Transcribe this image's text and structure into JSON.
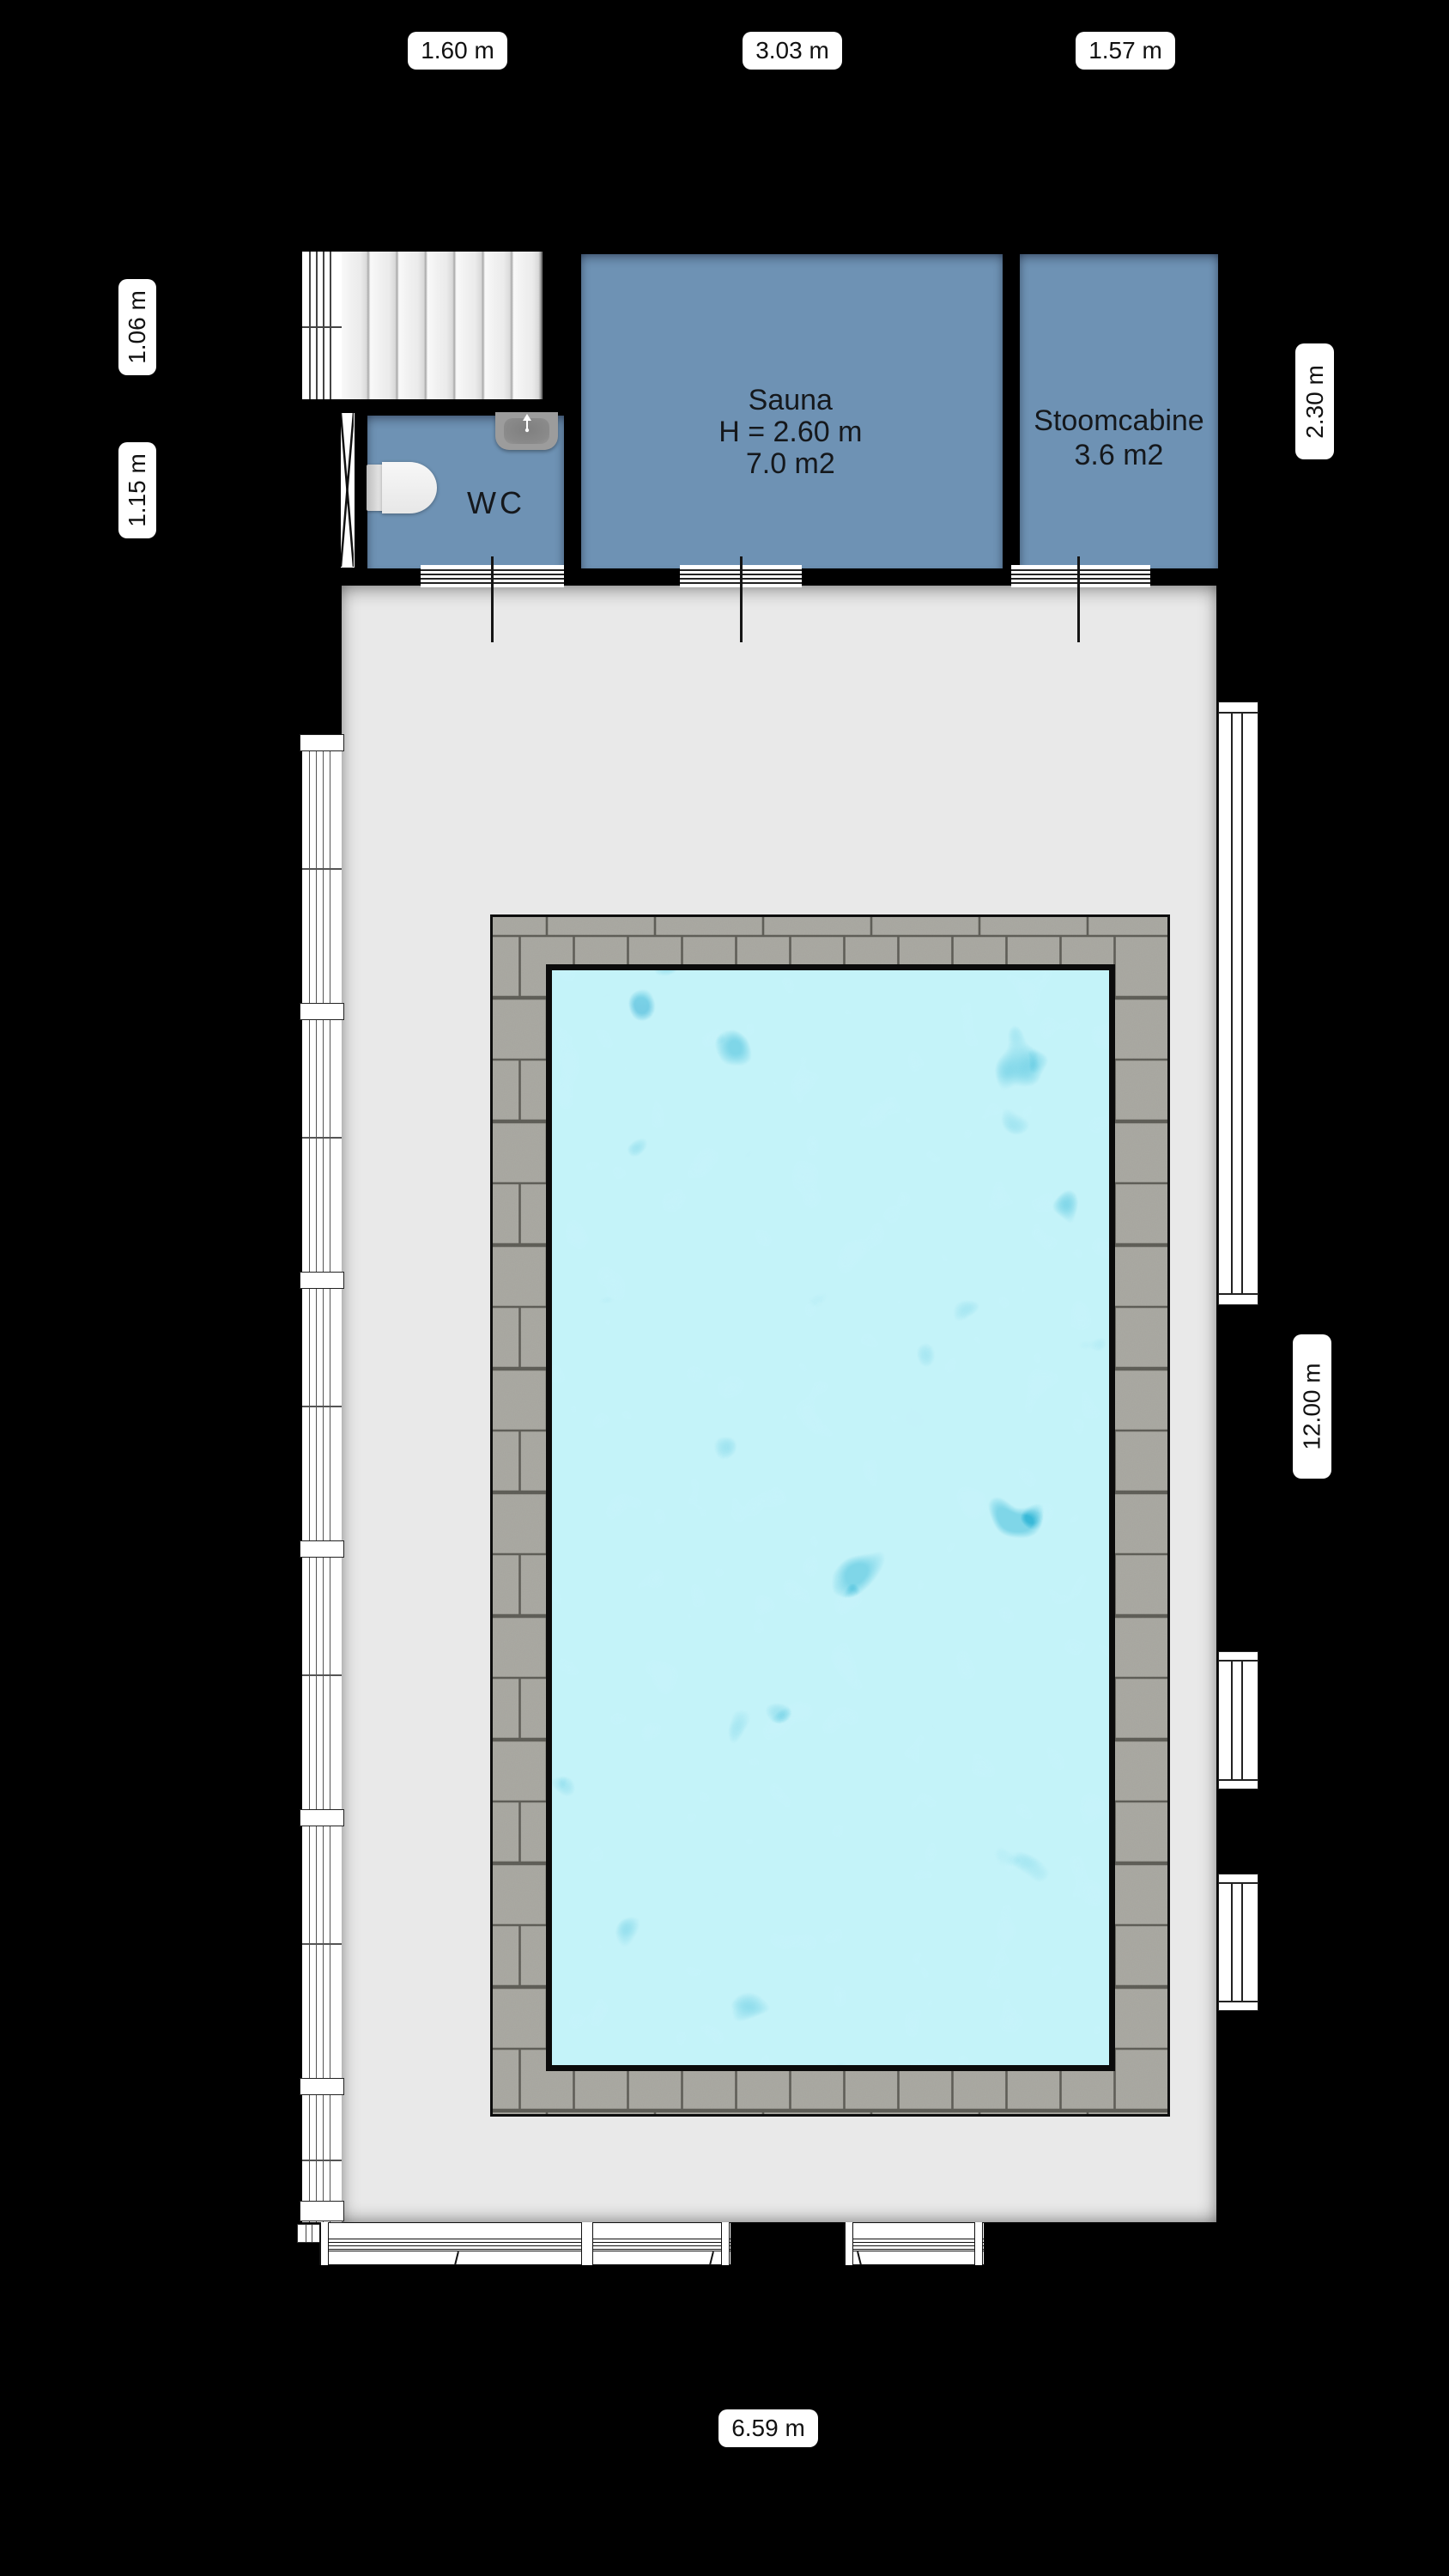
{
  "dimensions": {
    "top": [
      "1.60 m",
      "3.03 m",
      "1.57 m"
    ],
    "left": [
      "1.06 m",
      "1.15 m"
    ],
    "right_upper": "2.30 m",
    "right_lower": "12.00 m",
    "bottom": "6.59 m"
  },
  "rooms": {
    "sauna": {
      "name": "Sauna",
      "height": "H = 2.60 m",
      "area": "7.0 m2"
    },
    "stoomcabine": {
      "name": "Stoomcabine",
      "area": "3.6 m2"
    },
    "wc": {
      "name": "WC"
    }
  },
  "colors": {
    "wall": "#000000",
    "room_fill": "#6e92b4",
    "hall_floor": "#e9e9e9",
    "deck_paver": "#abaaa3",
    "deck_grout": "#5d5c55",
    "water_base": "#1797c9",
    "water_caustic": "#9feef7",
    "stairs": "#f2f2f2",
    "label_bg": "#ffffff",
    "label_text": "#111111"
  }
}
